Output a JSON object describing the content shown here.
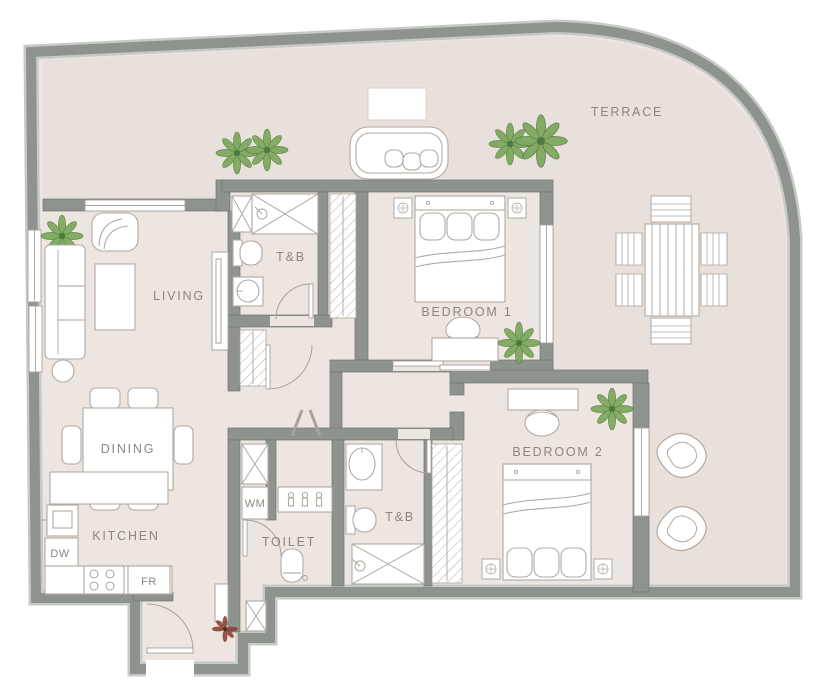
{
  "title": "Two-bedroom apartment floor plan with wrap-around terrace",
  "labels": {
    "terrace": "TERRACE",
    "living": "LIVING",
    "dining": "DINING",
    "kitchen": "KITCHEN",
    "toilet": "TOILET",
    "tb1": "T&B",
    "tb2": "T&B",
    "bedroom1": "BEDROOM 1",
    "bedroom2": "BEDROOM 2",
    "wm": "WM",
    "dw": "DW",
    "fr": "FR"
  },
  "colors": {
    "wall": "#8e938d",
    "wall-edge": "#6f756f",
    "wall-outer": "#c6c9c5",
    "floor": "#ede5e0",
    "terrace": "#e8e0da",
    "furn": "#b1a9a2",
    "line": "#a9a29b",
    "text": "#8c8680",
    "plant-dark": "#4e7a40",
    "plant-light": "#7fa95e",
    "plant-red": "#8e4437"
  },
  "rooms": [
    "TERRACE",
    "LIVING",
    "DINING",
    "KITCHEN",
    "TOILET",
    "T&B",
    "T&B",
    "BEDROOM 1",
    "BEDROOM 2"
  ],
  "appliances": [
    "WM",
    "DW",
    "FR"
  ]
}
